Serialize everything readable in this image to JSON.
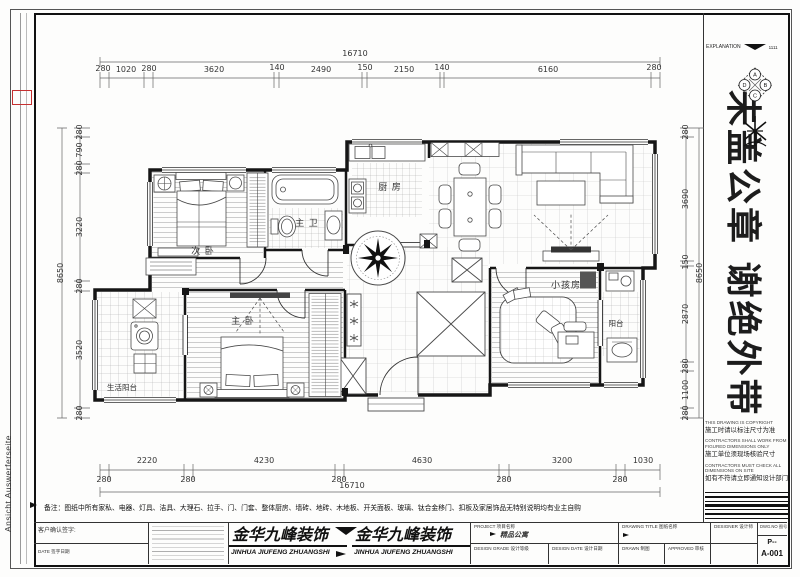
{
  "frame": {
    "explanation": "EXPLANATION",
    "explanation_code": "1111",
    "side_text": "Ansicht Auswerferseite",
    "watermark": "未盖公章 谢绝外带",
    "compass": {
      "top": "A",
      "right": "B",
      "bottom": "C",
      "left": "D"
    }
  },
  "dims": {
    "top_total": "16710",
    "top": [
      "280",
      "1020",
      "280",
      "3620",
      "140",
      "2490",
      "150",
      "2150",
      "140",
      "6160",
      "280"
    ],
    "bottom": [
      "2220",
      "4230",
      "4630",
      "3200",
      "1030"
    ],
    "bottom_minor": [
      "280",
      "280",
      "280",
      "280",
      "280"
    ],
    "bottom_total": "16710",
    "left": [
      "280",
      "790",
      "280",
      "3220",
      "280",
      "3520",
      "280"
    ],
    "left_total": "8650",
    "right": [
      "280",
      "3690",
      "150",
      "2870",
      "280",
      "1100",
      "280"
    ],
    "right_total": "8650"
  },
  "rooms": {
    "bedroom2": "次 卧",
    "bath": "主 卫",
    "kitchen": "厨 房",
    "kids": "小孩房",
    "master": "主 卧",
    "service_balcony": "生活阳台",
    "balcony": "阳台"
  },
  "right_panel": {
    "notes": [
      {
        "en": "THIS DRAWING IS COPYRIGHT",
        "cn": "施工时请以标注尺寸为准"
      },
      {
        "en": "CONTRACTORS SHALL WORK FROM FIGURED DIMENSIONS ONLY",
        "cn": "施工单位须现场核验尺寸"
      },
      {
        "en": "CONTRACTORS MUST CHECK ALL DIMENSIONS ON SITE",
        "cn": "如有不符请立即通知设计部门"
      }
    ]
  },
  "note_bottom": "备注：图纸中所有家私、电器、灯具、洁具、大理石、拉手、门、门套、整体厨房、墙砖、地砖、木地板、开关面板、玻璃、钛合金移门、扣板及家居饰品无特别说明均有业主自购",
  "title_block": {
    "client_sign": "客户确认签字:",
    "date_label": "DATE  签字日期",
    "brand_cn": "金华九峰装饰",
    "brand_en": "JINHUA JIUFENG ZHUANGSHI",
    "project_label": "PROJECT  项目名称",
    "project_value": "精品公寓",
    "design_grade_label": "DESIGN GRADE  设计等级",
    "design_date_label": "DESIGN DATE  设计日期",
    "drawing_title_label": "DRAWING TITLE  图纸名称",
    "drawn_label": "DRAWN  制图",
    "approved_label": "APPROVED  审核",
    "designer_label": "DESIGNER  设计师",
    "dwgno_label": "DWG.NO  图号",
    "dwgno_value1": "P--",
    "dwgno_value2": "A-001"
  }
}
